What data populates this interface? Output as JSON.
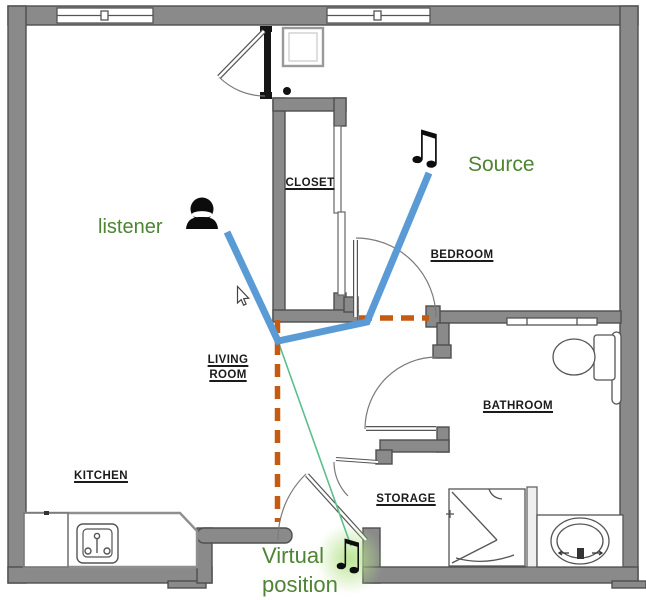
{
  "diagram": {
    "type": "apartment-floorplan-acoustics",
    "rooms": {
      "closet": {
        "label": "CLOSET"
      },
      "bedroom": {
        "label": "BEDROOM"
      },
      "living_room": {
        "line1": "LIVING",
        "line2": "ROOM"
      },
      "kitchen": {
        "label": "KITCHEN"
      },
      "bathroom": {
        "label": "BATHROOM"
      },
      "storage": {
        "label": "STORAGE"
      }
    },
    "annotations": {
      "listener": "listener",
      "source": "Source",
      "virtual_line1": "Virtual",
      "virtual_line2": "position"
    },
    "icons": {
      "music_note": "♫",
      "listener_person": "person-bust-icon",
      "cursor": "arrow-pointer-icon"
    },
    "colors": {
      "label_green": "#4e8434",
      "path_blue": "#5b9bd5",
      "wall_dashed_orange": "#c55a11",
      "virtual_path_green": "#5cbf8e",
      "glow_green": "#b6e28c",
      "wall_gray": "#8a8a8a",
      "ink_black": "#111111"
    }
  }
}
